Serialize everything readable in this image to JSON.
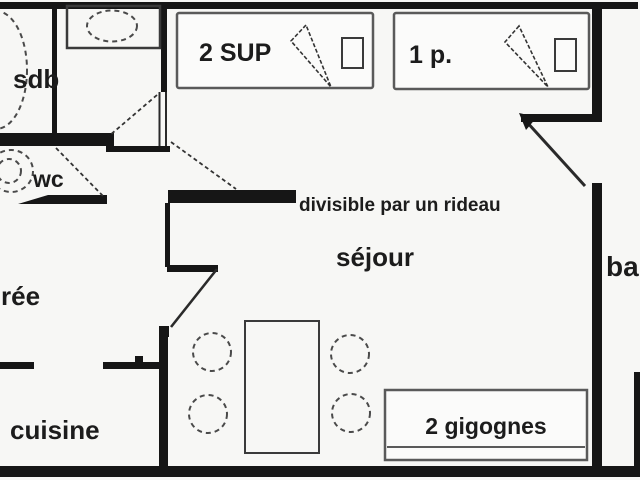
{
  "plan": {
    "rooms": {
      "bathroom": {
        "label": "sdb"
      },
      "toilet": {
        "label": "wc"
      },
      "entrance": {
        "label": "rée"
      },
      "kitchen": {
        "label": "cuisine"
      },
      "living_room": {
        "label": "séjour"
      },
      "balcony": {
        "label": "ba"
      }
    },
    "furniture": {
      "bed_double": {
        "label": "2 SUP"
      },
      "bed_single": {
        "label": "1 p."
      },
      "sofa_beds": {
        "label": "2 gigognes"
      }
    },
    "annotations": {
      "curtain_note": {
        "label": "divisible par un rideau"
      }
    },
    "colors": {
      "wall": "#161616",
      "fixture_stroke": "#4a4a4a",
      "text": "#1c1c1c",
      "background": "#f7f7f5"
    }
  }
}
